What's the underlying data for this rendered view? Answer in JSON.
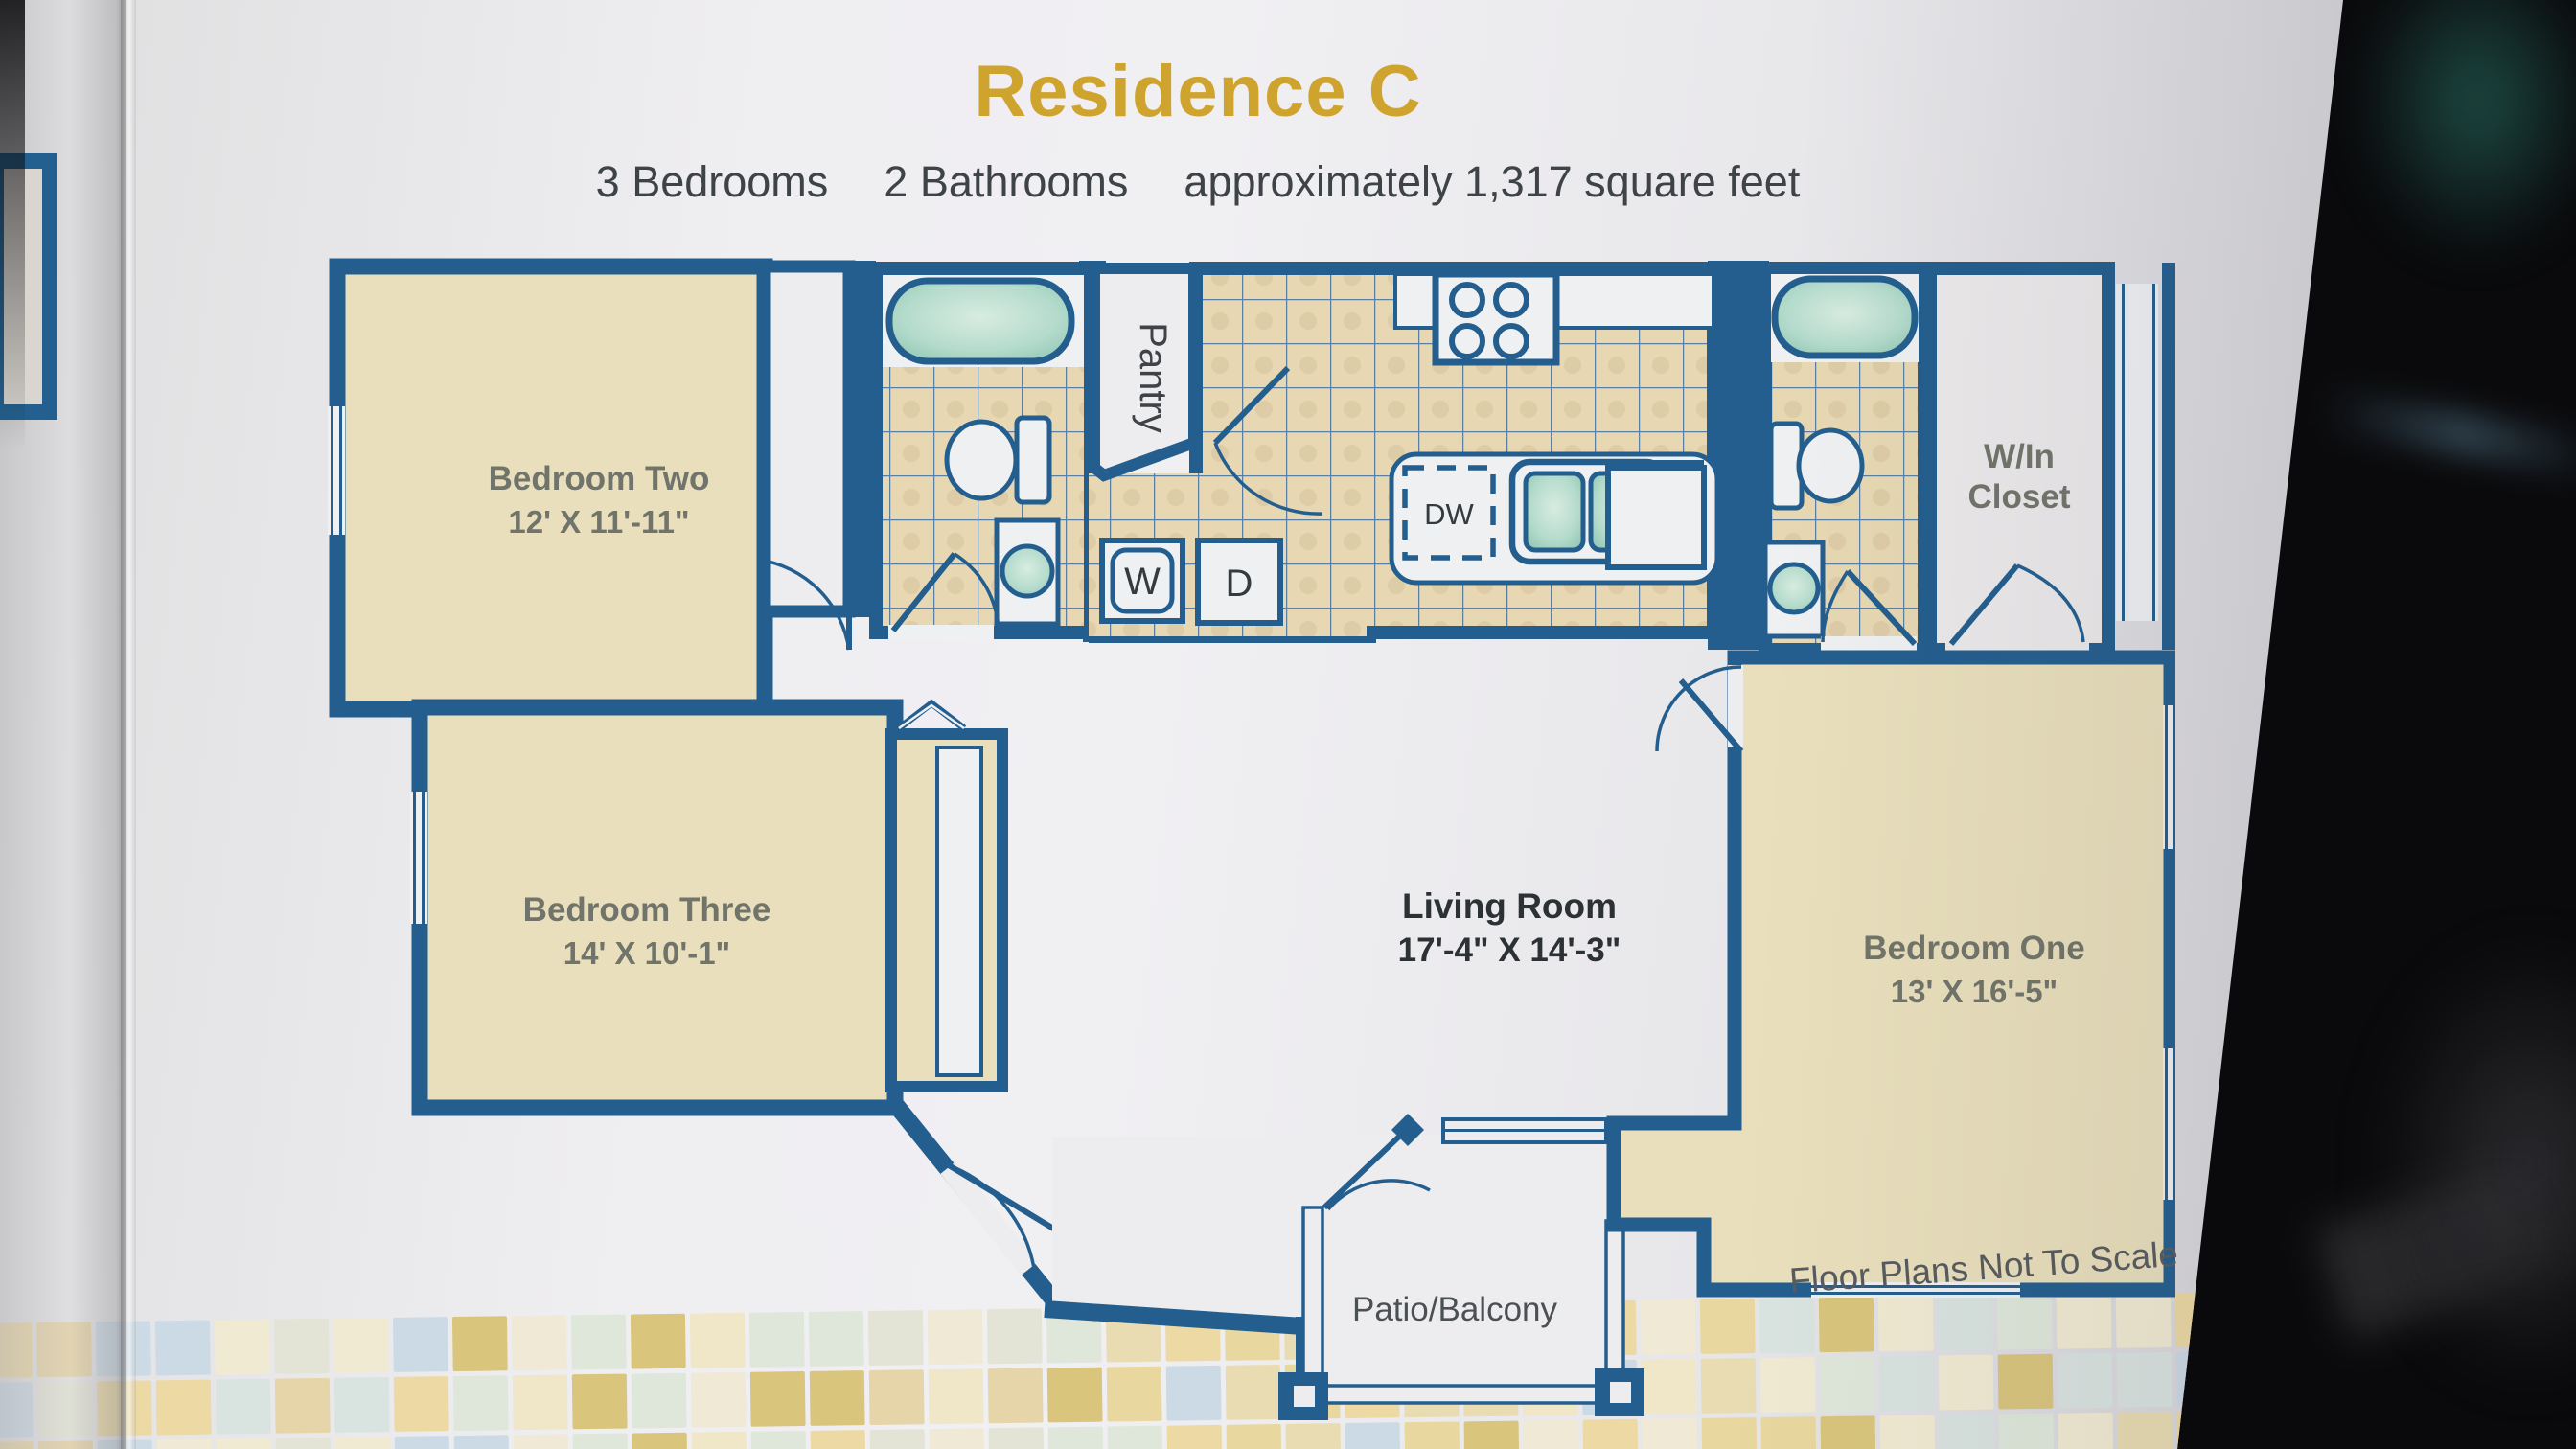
{
  "header": {
    "title": "Residence C",
    "bedrooms": "3 Bedrooms",
    "bathrooms": "2 Bathrooms",
    "area": "approximately 1,317 square feet"
  },
  "rooms": {
    "bedroom_one": {
      "name": "Bedroom One",
      "dims": "13' X 16'-5\""
    },
    "bedroom_two": {
      "name": "Bedroom Two",
      "dims": "12' X 11'-11\""
    },
    "bedroom_three": {
      "name": "Bedroom Three",
      "dims": "14' X 10'-1\""
    },
    "living_room": {
      "name": "Living Room",
      "dims": "17'-4\" X 14'-3\""
    },
    "pantry": "Pantry",
    "walk_in_closet_line1": "W/In",
    "walk_in_closet_line2": "Closet",
    "patio": "Patio/Balcony"
  },
  "appliances": {
    "washer": "W",
    "dryer": "D",
    "dishwasher": "DW"
  },
  "footer": {
    "note": "Floor Plans Not To Scale"
  },
  "colors": {
    "wall_navy": "#235e8e",
    "room_cream": "#e9dfbc",
    "tile_tan": "#e7d8b3",
    "grout_blue": "#5a7fa2",
    "fixture_teal": "#aed6c8",
    "title_gold": "#cfa42e",
    "label_gray": "#70746a",
    "label_dark": "#2c3134"
  },
  "mosaic_palette": [
    "#ecd9a4",
    "#f0e6c8",
    "#e3e4d6",
    "#d9e3df",
    "#e8d79e",
    "#d9c57c",
    "#ccdae5",
    "#efe9d6",
    "#e6d5a8",
    "#f1ead2",
    "#e9dcb2",
    "#dfe7da"
  ]
}
